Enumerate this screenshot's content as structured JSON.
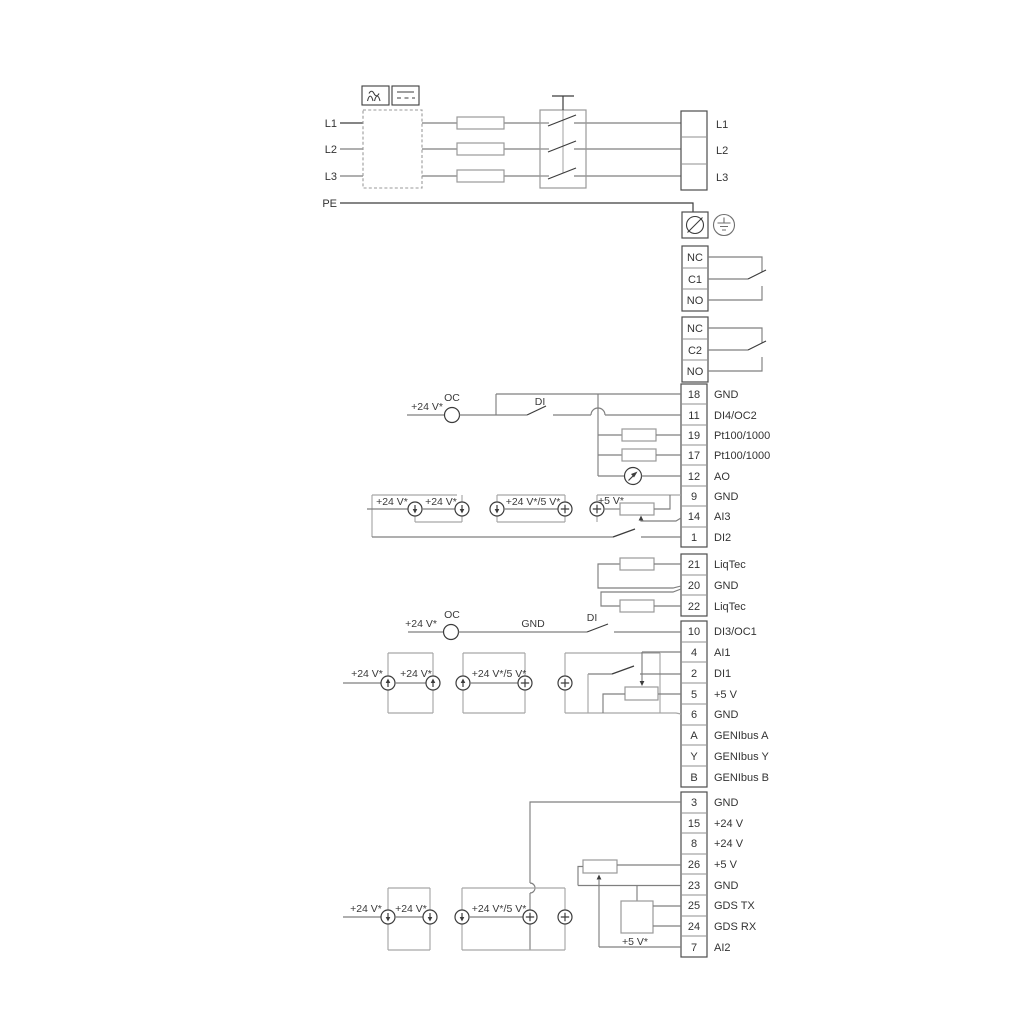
{
  "mains": {
    "in": [
      "L1",
      "L2",
      "L3",
      "PE"
    ],
    "out": [
      "L1",
      "L2",
      "L3"
    ]
  },
  "relay1": [
    "NC",
    "C1",
    "NO"
  ],
  "relay2": [
    "NC",
    "C2",
    "NO"
  ],
  "strip_mid": [
    {
      "n": "18",
      "l": "GND"
    },
    {
      "n": "11",
      "l": "DI4/OC2"
    },
    {
      "n": "19",
      "l": "Pt100/1000"
    },
    {
      "n": "17",
      "l": "Pt100/1000"
    },
    {
      "n": "12",
      "l": "AO"
    },
    {
      "n": "9",
      "l": "GND"
    },
    {
      "n": "14",
      "l": "AI3"
    },
    {
      "n": "1",
      "l": "DI2"
    }
  ],
  "strip_liqtec": [
    {
      "n": "21",
      "l": "LiqTec"
    },
    {
      "n": "20",
      "l": "GND"
    },
    {
      "n": "22",
      "l": "LiqTec"
    }
  ],
  "strip_low": [
    {
      "n": "10",
      "l": "DI3/OC1"
    },
    {
      "n": "4",
      "l": "AI1"
    },
    {
      "n": "2",
      "l": "DI1"
    },
    {
      "n": "5",
      "l": "+5 V"
    },
    {
      "n": "6",
      "l": "GND"
    },
    {
      "n": "A",
      "l": "GENIbus A"
    },
    {
      "n": "Y",
      "l": "GENIbus Y"
    },
    {
      "n": "B",
      "l": "GENIbus B"
    }
  ],
  "strip_bottom": [
    {
      "n": "3",
      "l": "GND"
    },
    {
      "n": "15",
      "l": "+24 V"
    },
    {
      "n": "8",
      "l": "+24 V"
    },
    {
      "n": "26",
      "l": "+5 V"
    },
    {
      "n": "23",
      "l": "GND"
    },
    {
      "n": "25",
      "l": "GDS TX"
    },
    {
      "n": "24",
      "l": "GDS RX"
    },
    {
      "n": "7",
      "l": "AI2"
    }
  ],
  "ann": {
    "v24": "+24 V*",
    "v24_5": "+24 V*/5 V*",
    "v5": "+5 V*",
    "oc": "OC",
    "di": "DI",
    "gnd": "GND"
  }
}
